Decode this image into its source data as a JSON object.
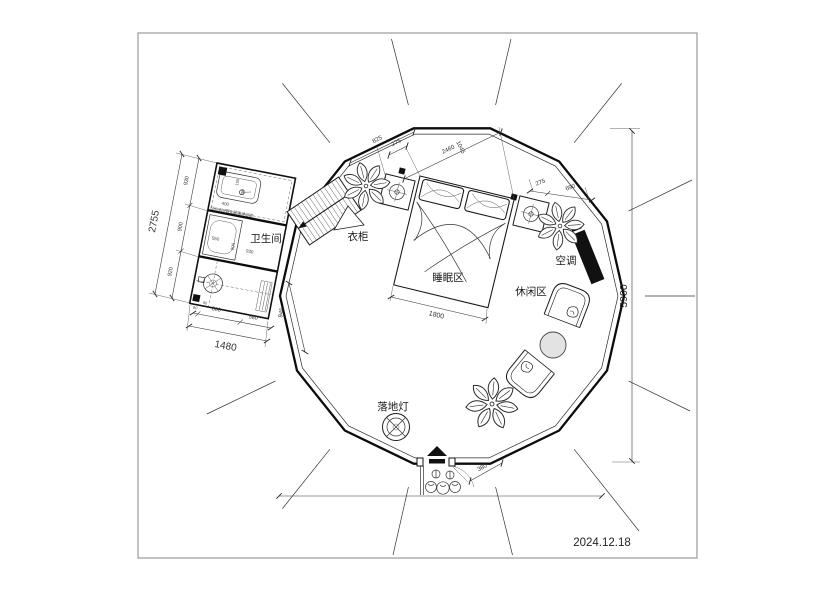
{
  "date": "2024.12.18",
  "labels": {
    "bathroom": "卫生间",
    "wardrobe": "衣柜",
    "sleeping_area": "睡眠区",
    "leisure_area": "休闲区",
    "air_conditioner": "空调",
    "floor_lamp": "落地灯"
  },
  "dims": {
    "overall_height": "5900",
    "top_left_edge": "825",
    "top_gap": "275",
    "bed_span": "2460",
    "bed_span_cross": "1045",
    "right_gap": "275",
    "right_edge": "690",
    "bed_width": "1800",
    "entrance_offset": "380",
    "left_wall_edge": "945",
    "bath_left_1": "930",
    "bath_left_2": "900",
    "bath_left_3": "920",
    "bath_left_total": "2755",
    "bath_bottom_0": "90",
    "bath_bottom_1": "800",
    "bath_bottom_2": "580",
    "bath_bottom_total": "1480",
    "shower_width": "400",
    "shower_a": "150",
    "shower_b": "700",
    "sink_width": "550",
    "bath_inner_depth": "900",
    "bath_inner_width": "930",
    "bath_corner": "90",
    "shower_note": "550x900钢化玻璃淋浴房"
  }
}
